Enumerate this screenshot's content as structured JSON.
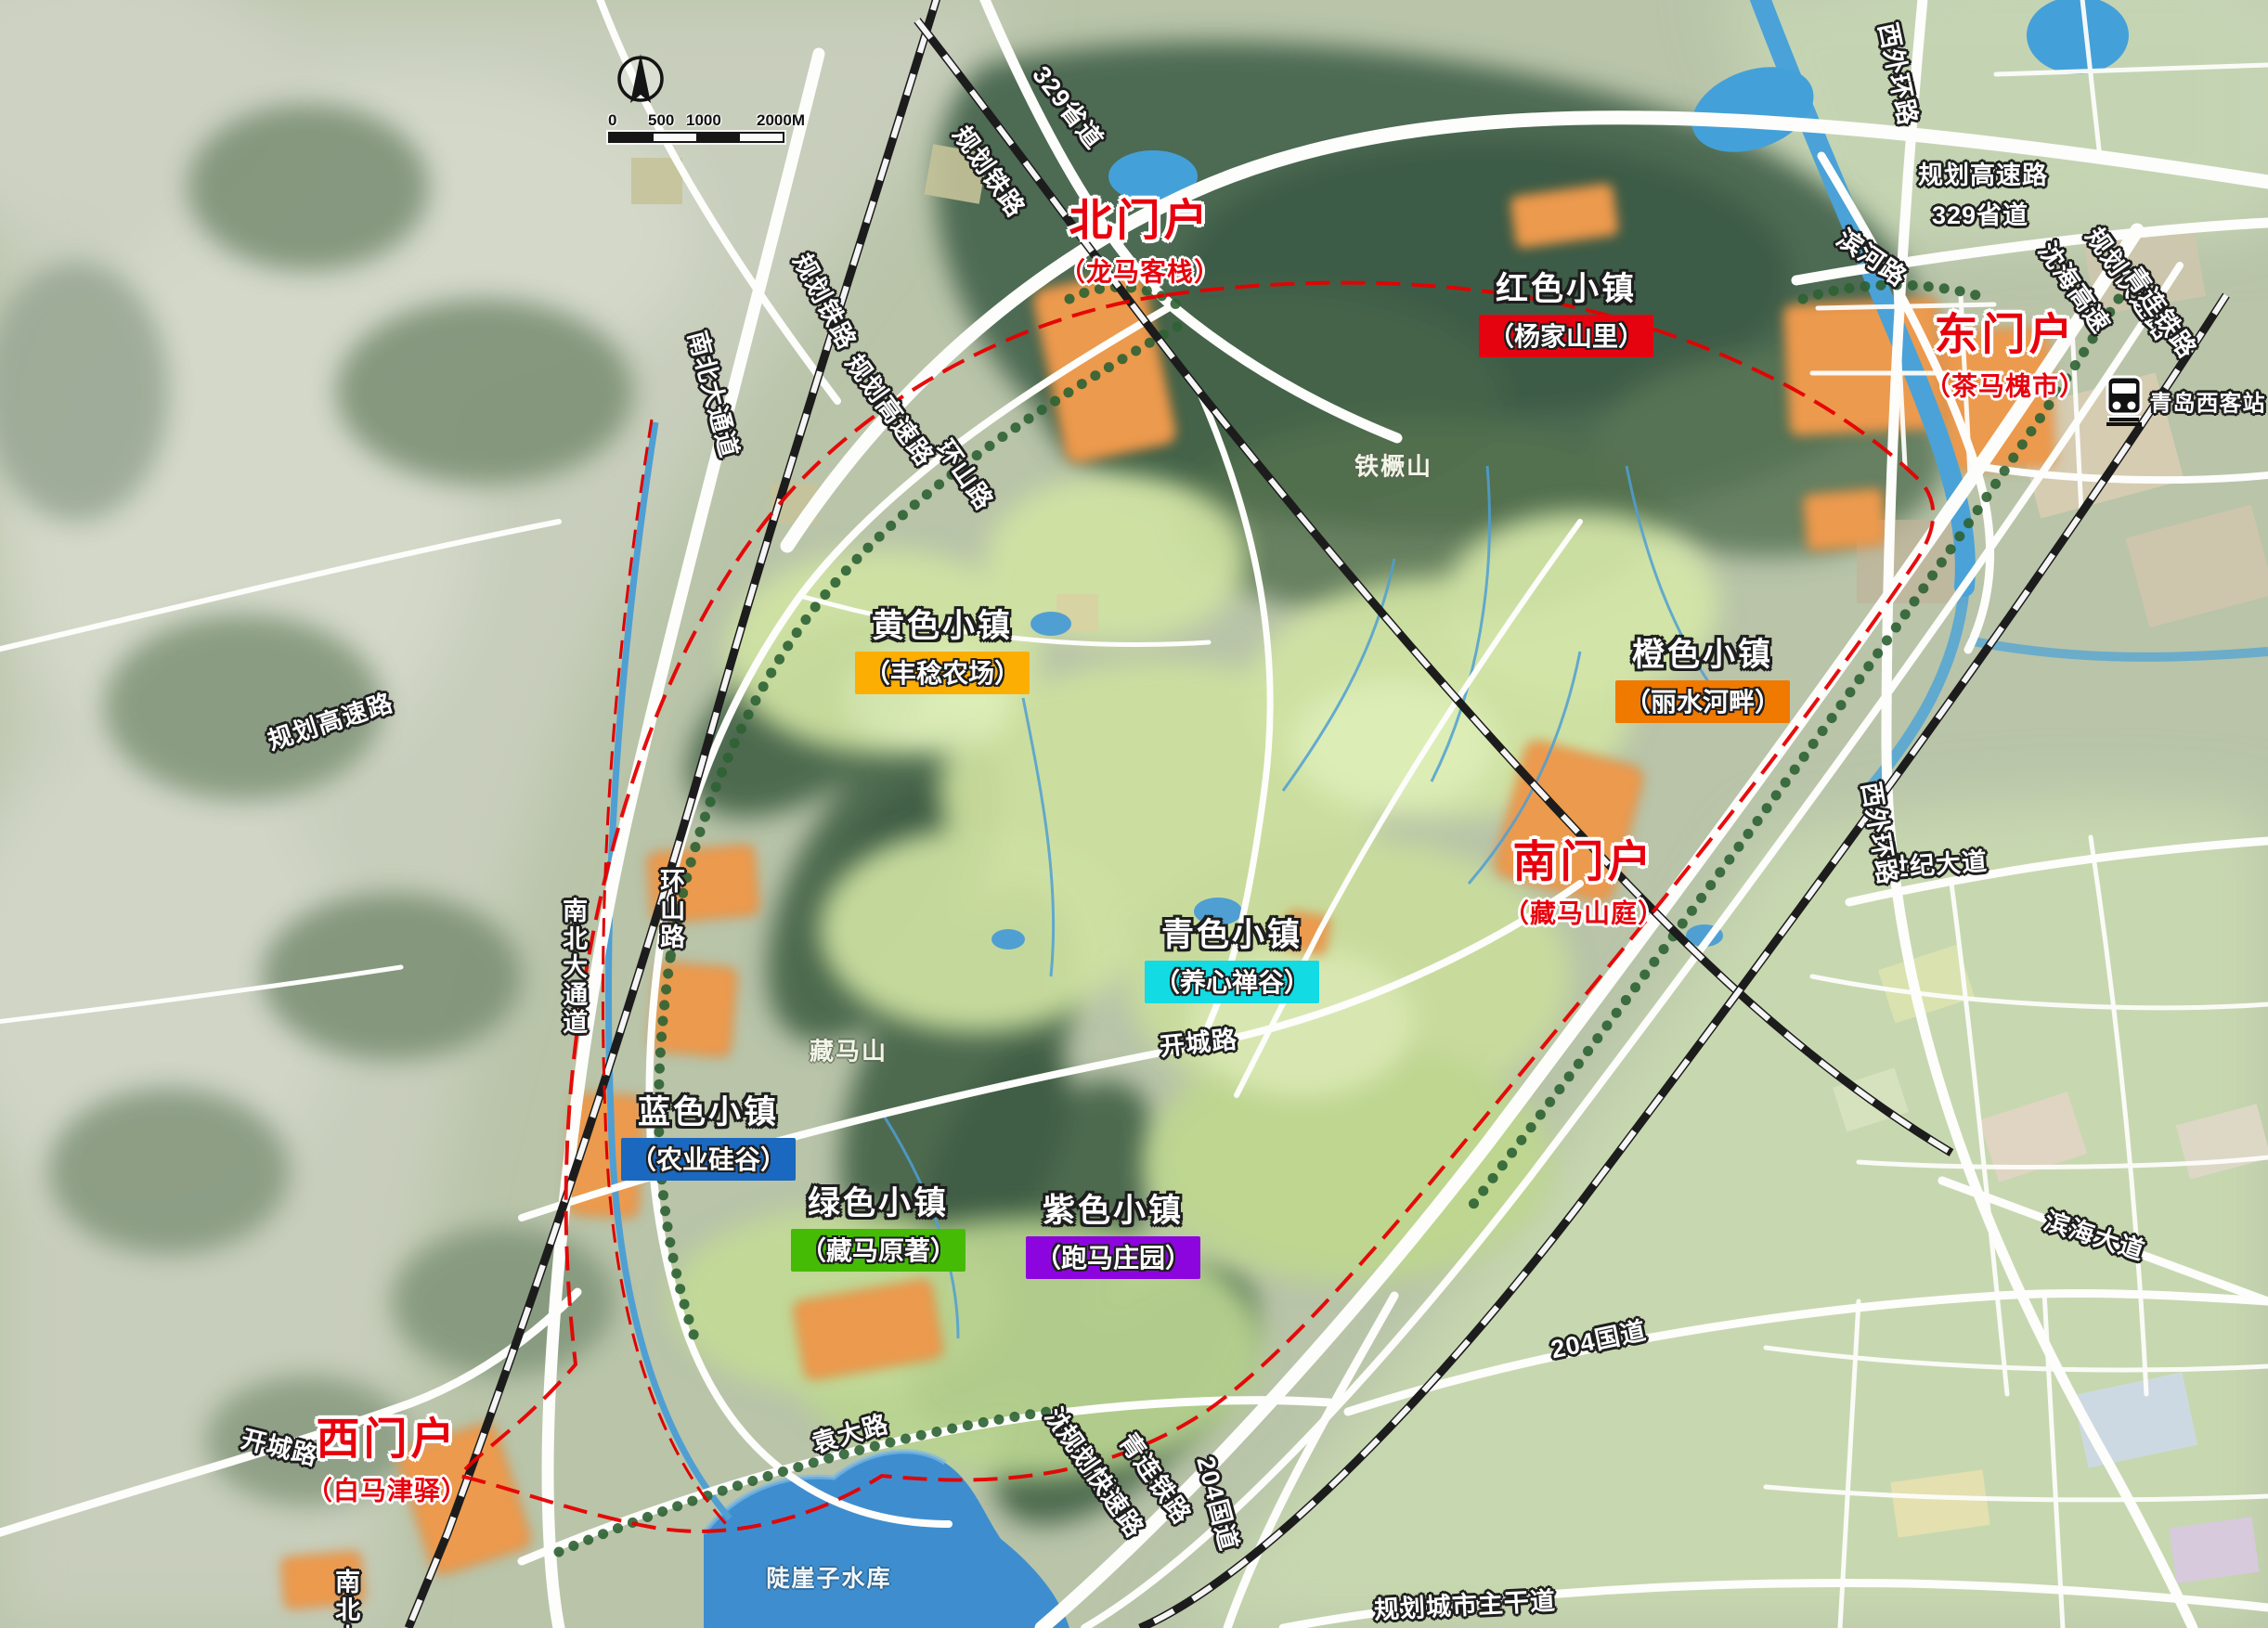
{
  "map": {
    "scale_bar": {
      "ticks": [
        "0",
        "500",
        "1000",
        "2000M"
      ]
    },
    "gates": {
      "north": {
        "title": "北门户",
        "subtitle": "（龙马客栈）"
      },
      "east": {
        "title": "东门户",
        "subtitle": "（茶马槐市）"
      },
      "south": {
        "title": "南门户",
        "subtitle": "（藏马山庭）"
      },
      "west": {
        "title": "西门户",
        "subtitle": "（白马津驿）"
      }
    },
    "towns": {
      "red": {
        "title": "红色小镇",
        "subtitle": "（杨家山里）",
        "color": "#e60310"
      },
      "orange": {
        "title": "橙色小镇",
        "subtitle": "（丽水河畔）",
        "color": "#f07900"
      },
      "yellow": {
        "title": "黄色小镇",
        "subtitle": "（丰稔农场）",
        "color": "#fcae02"
      },
      "cyan": {
        "title": "青色小镇",
        "subtitle": "（养心禅谷）",
        "color": "#12dbe3"
      },
      "blue": {
        "title": "蓝色小镇",
        "subtitle": "（农业硅谷）",
        "color": "#1a68c0"
      },
      "green": {
        "title": "绿色小镇",
        "subtitle": "（藏马原著）",
        "color": "#46bb05"
      },
      "purple": {
        "title": "紫色小镇",
        "subtitle": "（跑马庄园）",
        "color": "#8d05de"
      }
    },
    "roads": {
      "rail_planned": "规划铁路",
      "hwy_planned": "规划高速路",
      "s329": "329省道",
      "binhe": "滨河路",
      "xiwaihuan": "西外环路",
      "shenhai": "沈海高速",
      "expressway_planned": "规划快速路",
      "qinglian": "青连铁路",
      "nanbei": "南北大通道",
      "huanshan": "环山路",
      "kaicheng": "开城路",
      "shiji": "世纪大道",
      "binhai": "滨海大道",
      "g204": "204国道",
      "yuanda": "袁大路",
      "main_trunk": "规划城市主干道"
    },
    "landmarks": {
      "station": "青岛西客站",
      "mount_tiejue": "铁橛山",
      "mount_zangma": "藏马山",
      "reservoir": "陡崖子水库"
    }
  }
}
